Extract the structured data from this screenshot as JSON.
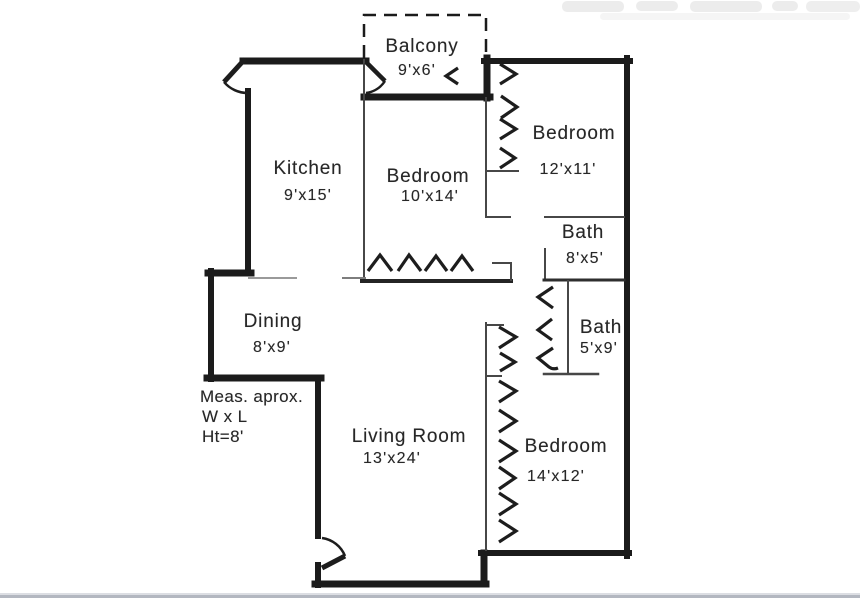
{
  "rooms": [
    {
      "id": "balcony",
      "name": "Balcony",
      "dims": "9'x6'"
    },
    {
      "id": "kitchen",
      "name": "Kitchen",
      "dims": "9'x15'"
    },
    {
      "id": "bedroom-10x14",
      "name": "Bedroom",
      "dims": "10'x14'"
    },
    {
      "id": "bedroom-12x11",
      "name": "Bedroom",
      "dims": "12'x11'"
    },
    {
      "id": "bath-8x5",
      "name": "Bath",
      "dims": "8'x5'"
    },
    {
      "id": "bath-5x9",
      "name": "Bath",
      "dims": "5'x9'"
    },
    {
      "id": "dining",
      "name": "Dining",
      "dims": "8'x9'"
    },
    {
      "id": "living-room",
      "name": "Living Room",
      "dims": "13'x24'"
    },
    {
      "id": "bedroom-14x12",
      "name": "Bedroom",
      "dims": "14'x12'"
    }
  ],
  "measurement_note": {
    "line1": "Meas. aprox.",
    "line2": "W x L",
    "line3": "Ht=8'"
  },
  "colors": {
    "wall": "#1b1b1b",
    "thin_wall": "#474747",
    "text": "#272727",
    "footer_rule": "#b3b7c0",
    "background": "#ffffff"
  }
}
